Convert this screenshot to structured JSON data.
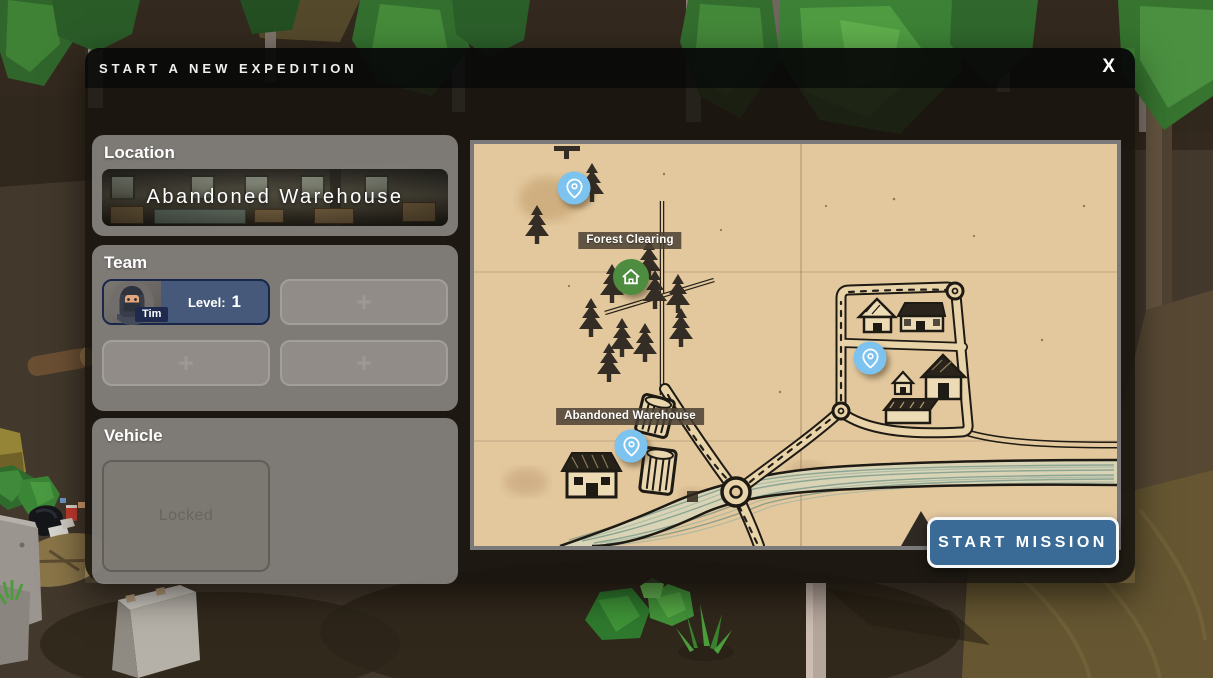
{
  "dialog": {
    "title": "START A NEW EXPEDITION",
    "close_label": "X",
    "location": {
      "heading": "Location",
      "name": "Abandoned Warehouse"
    },
    "team": {
      "heading": "Team",
      "member": {
        "name": "Tim",
        "level_label": "Level:",
        "level_value": "1"
      },
      "add_label": "+"
    },
    "vehicle": {
      "heading": "Vehicle",
      "locked_label": "Locked"
    },
    "start_button_label": "START MISSION"
  },
  "map": {
    "labels": {
      "forest_clearing": "Forest Clearing",
      "abandoned_warehouse": "Abandoned Warehouse"
    },
    "markers": [
      {
        "name": "camp-pin",
        "icon": "pin-icon",
        "color": "#7cc3ef"
      },
      {
        "name": "forest-clearing-home",
        "icon": "home-icon",
        "color": "#4e8c3f"
      },
      {
        "name": "town-pin",
        "icon": "pin-icon",
        "color": "#7cc3ef"
      },
      {
        "name": "abandoned-warehouse-pin",
        "icon": "pin-icon",
        "color": "#7cc3ef"
      }
    ],
    "colors": {
      "paper": "#e3c89e",
      "ink": "#1e1a14",
      "river": "#d9d4b6"
    }
  },
  "theme": {
    "accent_blue": "#3a6a96",
    "selected_slot_blue": "#47597b",
    "marker_blue": "#7cc3ef",
    "marker_green": "#4e8c3f"
  }
}
